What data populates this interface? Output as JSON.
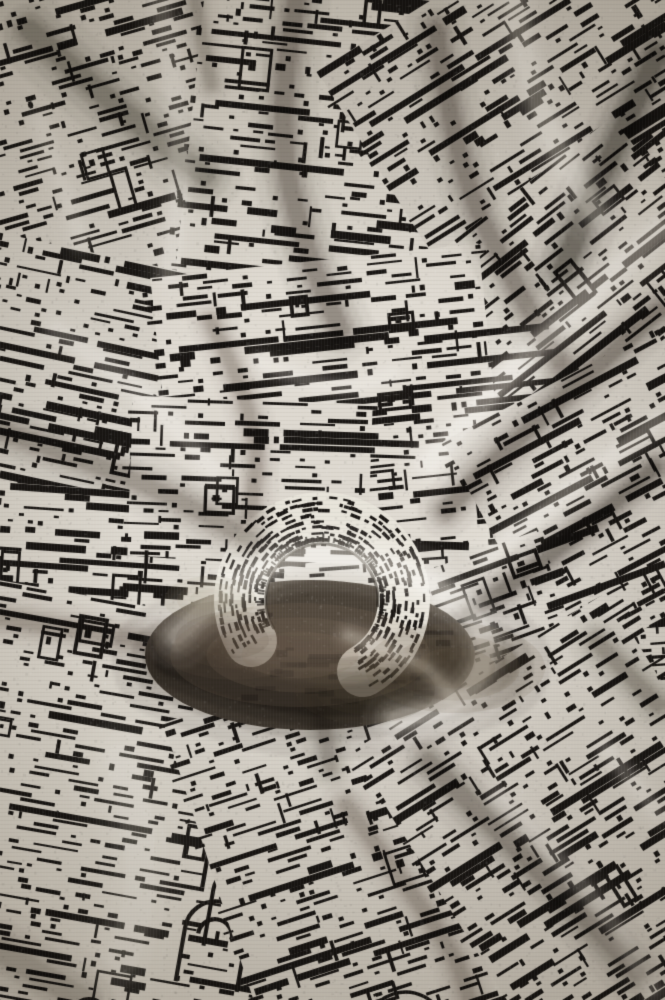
{
  "meta": {
    "title": "Crumpled black-and-white jacquard knit fabric",
    "description": "Close-up photograph of a black and white jacquard knitted fabric printed with an abstract pixelated cityscape / architectural pattern. The cloth is crumpled, with drape folds radiating toward a central rolled twist just below the middle, deep warm-brown shadows under the twist, and soft daylight falling from the upper right.",
    "width": 665,
    "height": 1000
  },
  "palette": {
    "base": "#d9d4cb",
    "base_light": "#e9e5dc",
    "base_dark": "#c9c4bb",
    "ink": "#191613",
    "shadow_deep": "#2e2820",
    "shadow_warm": "#6e6052",
    "blur_brown": "#8b7a67",
    "highlight": "#fff6e8",
    "vignette_edge": "#b3ada3"
  },
  "scene": {
    "texture": {
      "seed": 1337,
      "cell": 5,
      "row_step": 7,
      "stitch_v": 3,
      "stitch_h": 4,
      "speckles": 7000
    },
    "patches": [
      {
        "cx": 332,
        "cy": 500,
        "w": 720,
        "h": 1060,
        "angle": -4,
        "density": 0.3,
        "bar": 0.18,
        "windows": 8,
        "arches": 0,
        "tone": "#d9d4cb"
      },
      {
        "cx": 140,
        "cy": 150,
        "w": 420,
        "h": 420,
        "angle": -16,
        "density": 0.34,
        "bar": 0.2,
        "windows": 6,
        "arches": 0,
        "tone": "#d7d2c9"
      },
      {
        "cx": 340,
        "cy": 140,
        "w": 300,
        "h": 380,
        "angle": 6,
        "density": 0.3,
        "bar": 0.22,
        "windows": 5,
        "arches": 0,
        "tone": "#ddd8cf"
      },
      {
        "cx": 560,
        "cy": 120,
        "w": 360,
        "h": 340,
        "angle": -32,
        "density": 0.36,
        "bar": 0.2,
        "windows": 4,
        "arches": 0,
        "tone": "#d5d0c7"
      },
      {
        "cx": 570,
        "cy": 340,
        "w": 340,
        "h": 300,
        "angle": -38,
        "density": 0.33,
        "bar": 0.18,
        "windows": 4,
        "arches": 0,
        "tone": "#dad5cc"
      },
      {
        "cx": 110,
        "cy": 430,
        "w": 320,
        "h": 340,
        "angle": 12,
        "density": 0.34,
        "bar": 0.25,
        "windows": 6,
        "arches": 0,
        "tone": "#d9d4cb"
      },
      {
        "cx": 330,
        "cy": 410,
        "w": 330,
        "h": 300,
        "angle": -6,
        "density": 0.3,
        "bar": 0.2,
        "windows": 6,
        "arches": 0,
        "tone": "#e0dbd2"
      },
      {
        "cx": 610,
        "cy": 500,
        "w": 240,
        "h": 260,
        "angle": -28,
        "density": 0.33,
        "bar": 0.18,
        "windows": 3,
        "arches": 0,
        "tone": "#d6d1c8"
      },
      {
        "cx": 110,
        "cy": 590,
        "w": 300,
        "h": 200,
        "angle": 4,
        "density": 0.32,
        "bar": 0.3,
        "windows": 4,
        "arches": 0,
        "tone": "#dcd7ce"
      },
      {
        "cx": 250,
        "cy": 480,
        "w": 240,
        "h": 160,
        "angle": 2,
        "density": 0.3,
        "bar": 0.2,
        "windows": 3,
        "arches": 0,
        "tone": "#ded9d0"
      },
      {
        "cx": 470,
        "cy": 640,
        "w": 200,
        "h": 160,
        "angle": -20,
        "density": 0.34,
        "bar": 0.2,
        "windows": 2,
        "arches": 0,
        "tone": "#d8d3ca"
      },
      {
        "cx": 150,
        "cy": 830,
        "w": 440,
        "h": 440,
        "angle": 10,
        "density": 0.3,
        "bar": 0.22,
        "windows": 8,
        "arches": 6,
        "tone": "#ddd8cf"
      },
      {
        "cx": 390,
        "cy": 870,
        "w": 340,
        "h": 420,
        "angle": -18,
        "density": 0.33,
        "bar": 0.2,
        "windows": 7,
        "arches": 2,
        "tone": "#dad5cc"
      },
      {
        "cx": 590,
        "cy": 850,
        "w": 300,
        "h": 420,
        "angle": -32,
        "density": 0.35,
        "bar": 0.2,
        "windows": 5,
        "arches": 0,
        "tone": "#d7d2c9"
      }
    ],
    "knot": {
      "well": {
        "x": 310,
        "y": 655,
        "rx": 165,
        "ry": 75,
        "tone": "#4a4238"
      },
      "ring": {
        "cx": 322,
        "cy": 600,
        "rin": 56,
        "rout": 108,
        "a0": 150,
        "a1": 420,
        "tone": "#e8e4da",
        "edge": "#241f19"
      }
    },
    "folds": {
      "dark": [
        {
          "pts": [
            [
              298,
              0
            ],
            [
              276,
              120
            ],
            [
              306,
              250
            ],
            [
              342,
              330
            ]
          ],
          "w": 26,
          "a": 0.5,
          "color": "#4a4036"
        },
        {
          "pts": [
            [
              30,
              30
            ],
            [
              120,
              110
            ],
            [
              205,
              175
            ]
          ],
          "w": 30,
          "a": 0.45,
          "color": "#3c342b"
        },
        {
          "pts": [
            [
              438,
              30
            ],
            [
              458,
              170
            ],
            [
              520,
              290
            ],
            [
              562,
              362
            ]
          ],
          "w": 24,
          "a": 0.5,
          "color": "#4a4036"
        },
        {
          "pts": [
            [
              660,
              55
            ],
            [
              606,
              170
            ],
            [
              566,
              268
            ]
          ],
          "w": 28,
          "a": 0.62,
          "color": "#332c24"
        },
        {
          "pts": [
            [
              662,
              310
            ],
            [
              540,
              420
            ],
            [
              448,
              510
            ]
          ],
          "w": 22,
          "a": 0.5,
          "color": "#443b31"
        },
        {
          "pts": [
            [
              658,
              468
            ],
            [
              556,
              556
            ],
            [
              470,
              614
            ]
          ],
          "w": 20,
          "a": 0.55,
          "color": "#3c342b"
        },
        {
          "pts": [
            [
              0,
              430
            ],
            [
              140,
              478
            ],
            [
              252,
              540
            ]
          ],
          "w": 24,
          "a": 0.4,
          "color": "#4a4036"
        },
        {
          "pts": [
            [
              0,
              618
            ],
            [
              110,
              636
            ],
            [
              218,
              650
            ]
          ],
          "w": 20,
          "a": 0.35,
          "color": "#54493d"
        },
        {
          "pts": [
            [
              172,
              660
            ],
            [
              262,
              698
            ],
            [
              380,
              702
            ],
            [
              494,
              664
            ]
          ],
          "w": 46,
          "a": 0.72,
          "color": "#2e2820"
        },
        {
          "pts": [
            [
              430,
              762
            ],
            [
              548,
              876
            ],
            [
              640,
              972
            ]
          ],
          "w": 26,
          "a": 0.45,
          "color": "#443b31"
        },
        {
          "pts": [
            [
              348,
              806
            ],
            [
              452,
              940
            ],
            [
              472,
              1000
            ]
          ],
          "w": 20,
          "a": 0.35,
          "color": "#54493d"
        },
        {
          "pts": [
            [
              320,
              700
            ],
            [
              332,
              768
            ]
          ],
          "w": 18,
          "a": 0.35,
          "color": "#4a4036"
        },
        {
          "pts": [
            [
              212,
              322
            ],
            [
              262,
              420
            ],
            [
              252,
              512
            ]
          ],
          "w": 18,
          "a": 0.35,
          "color": "#54493d"
        },
        {
          "pts": [
            [
              0,
              950
            ],
            [
              84,
              1000
            ]
          ],
          "w": 34,
          "a": 0.3,
          "color": "#4a4036"
        },
        {
          "pts": [
            [
              600,
              642
            ],
            [
              660,
              704
            ]
          ],
          "w": 22,
          "a": 0.4,
          "color": "#443b31"
        },
        {
          "pts": [
            [
              196,
              0
            ],
            [
              212,
              84
            ]
          ],
          "w": 16,
          "a": 0.3,
          "color": "#4a4036"
        }
      ],
      "light": [
        {
          "pts": [
            [
              516,
              0
            ],
            [
              536,
              110
            ],
            [
              598,
              212
            ]
          ],
          "w": 26,
          "a": 0.5,
          "color": "#fff6e8"
        },
        {
          "pts": [
            [
              160,
              0
            ],
            [
              188,
              140
            ],
            [
              170,
              272
            ]
          ],
          "w": 22,
          "a": 0.35,
          "color": "#fff6e8"
        },
        {
          "pts": [
            [
              662,
              230
            ],
            [
              540,
              342
            ],
            [
              432,
              462
            ]
          ],
          "w": 26,
          "a": 0.55,
          "color": "#fff6e8"
        },
        {
          "pts": [
            [
              662,
              420
            ],
            [
              574,
              488
            ],
            [
              486,
              560
            ]
          ],
          "w": 18,
          "a": 0.4,
          "color": "#fff6e8"
        },
        {
          "pts": [
            [
              178,
              636
            ],
            [
              240,
              572
            ],
            [
              330,
              550
            ],
            [
              432,
              578
            ],
            [
              498,
              634
            ],
            [
              470,
              704
            ],
            [
              398,
              720
            ]
          ],
          "w": 26,
          "a": 0.7,
          "color": "#fff6e8"
        },
        {
          "pts": [
            [
              350,
              636
            ],
            [
              420,
              658
            ],
            [
              452,
              694
            ]
          ],
          "w": 14,
          "a": 0.5,
          "color": "#fff6e8"
        },
        {
          "pts": [
            [
              56,
              330
            ],
            [
              142,
              386
            ],
            [
              214,
              470
            ]
          ],
          "w": 20,
          "a": 0.3,
          "color": "#fff6e8"
        },
        {
          "pts": [
            [
              122,
              760
            ],
            [
              152,
              862
            ],
            [
              122,
              960
            ]
          ],
          "w": 46,
          "a": 0.28,
          "color": "#fff6e8"
        },
        {
          "pts": [
            [
              500,
              796
            ],
            [
              598,
              894
            ],
            [
              656,
              990
            ]
          ],
          "w": 20,
          "a": 0.3,
          "color": "#fff6e8"
        },
        {
          "pts": [
            [
              608,
              748
            ],
            [
              660,
              812
            ]
          ],
          "w": 16,
          "a": 0.3,
          "color": "#fff6e8"
        },
        {
          "pts": [
            [
              262,
              362
            ],
            [
              330,
              394
            ],
            [
              394,
              374
            ]
          ],
          "w": 16,
          "a": 0.3,
          "color": "#fff6e8"
        },
        {
          "pts": [
            [
              40,
              120
            ],
            [
              82,
              242
            ]
          ],
          "w": 18,
          "a": 0.25,
          "color": "#fff6e8"
        }
      ]
    },
    "blobs": [
      {
        "x": 300,
        "y": 655,
        "rx": 130,
        "ry": 52,
        "color": "#8b7a67",
        "a": 0.5
      },
      {
        "x": 233,
        "y": 640,
        "rx": 80,
        "ry": 40,
        "color": "#5d5042",
        "a": 0.5
      },
      {
        "x": 455,
        "y": 668,
        "rx": 90,
        "ry": 45,
        "color": "#6e5e4d",
        "a": 0.45
      },
      {
        "x": 365,
        "y": 690,
        "rx": 70,
        "ry": 34,
        "color": "#4a3f33",
        "a": 0.4
      },
      {
        "x": 210,
        "y": 600,
        "rx": 46,
        "ry": 24,
        "color": "#9a8a76",
        "a": 0.35
      }
    ],
    "vignette": {
      "cx": 340,
      "cy": 500,
      "inner": 220,
      "outer": 760,
      "edge": "#b3ada3"
    }
  }
}
